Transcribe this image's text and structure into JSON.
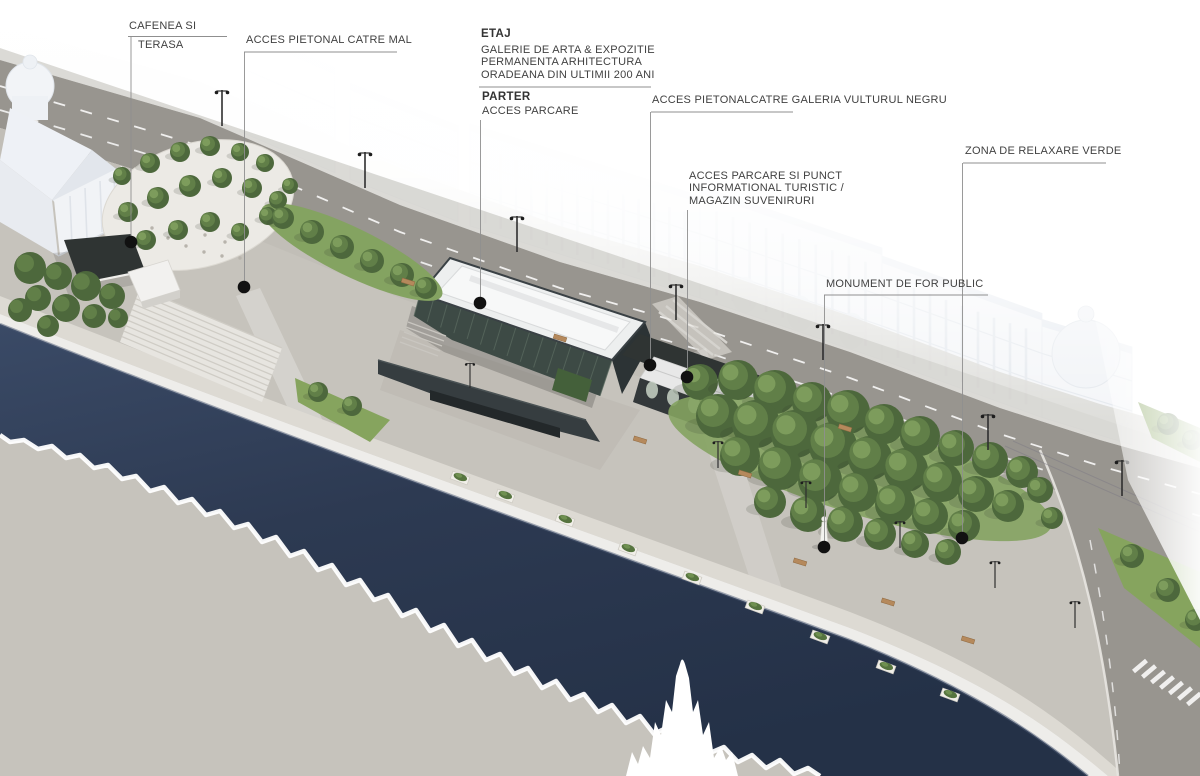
{
  "annotations": {
    "cafenea": {
      "line1": "CAFENEA SI",
      "line2": "TERASA"
    },
    "acces_mal": {
      "text": "ACCES PIETONAL CATRE MAL"
    },
    "etaj": {
      "title": "ETAJ",
      "body": "GALERIE DE ARTA & EXPOZITIE\nPERMANENTA ARHITECTURA\nORADEANA DIN ULTIMII 200 ANI"
    },
    "parter": {
      "title": "PARTER",
      "body": "ACCES PARCARE"
    },
    "galeria": {
      "text": "ACCES PIETONALCATRE GALERIA VULTURUL NEGRU"
    },
    "info": {
      "text": "ACCES PARCARE SI PUNCT\nINFORMATIONAL TURISTIC /\nMAGAZIN SUVENIRURI"
    },
    "monument": {
      "text": "MONUMENT DE FOR PUBLIC"
    },
    "zona": {
      "text": "ZONA DE RELAXARE VERDE"
    }
  },
  "colors": {
    "water": "#2d3a52",
    "water_deep": "#243147",
    "road": "#98958f",
    "plaza": "#c6c3bc",
    "promenade": "#dddad3",
    "quay_wall": "#eeedea",
    "green_bed": "#84a361",
    "lawn": "#86a45e",
    "tree_dark": "#4d683c",
    "tree_mid": "#617f48",
    "tree_light": "#7d9c5c",
    "glass_building": "#3d4a45",
    "roof_white": "#edefef",
    "dark_pavilion": "#2f3433",
    "label_text": "#414141",
    "leader_line": "#8f8f8f",
    "marker_dot": "#111111"
  }
}
